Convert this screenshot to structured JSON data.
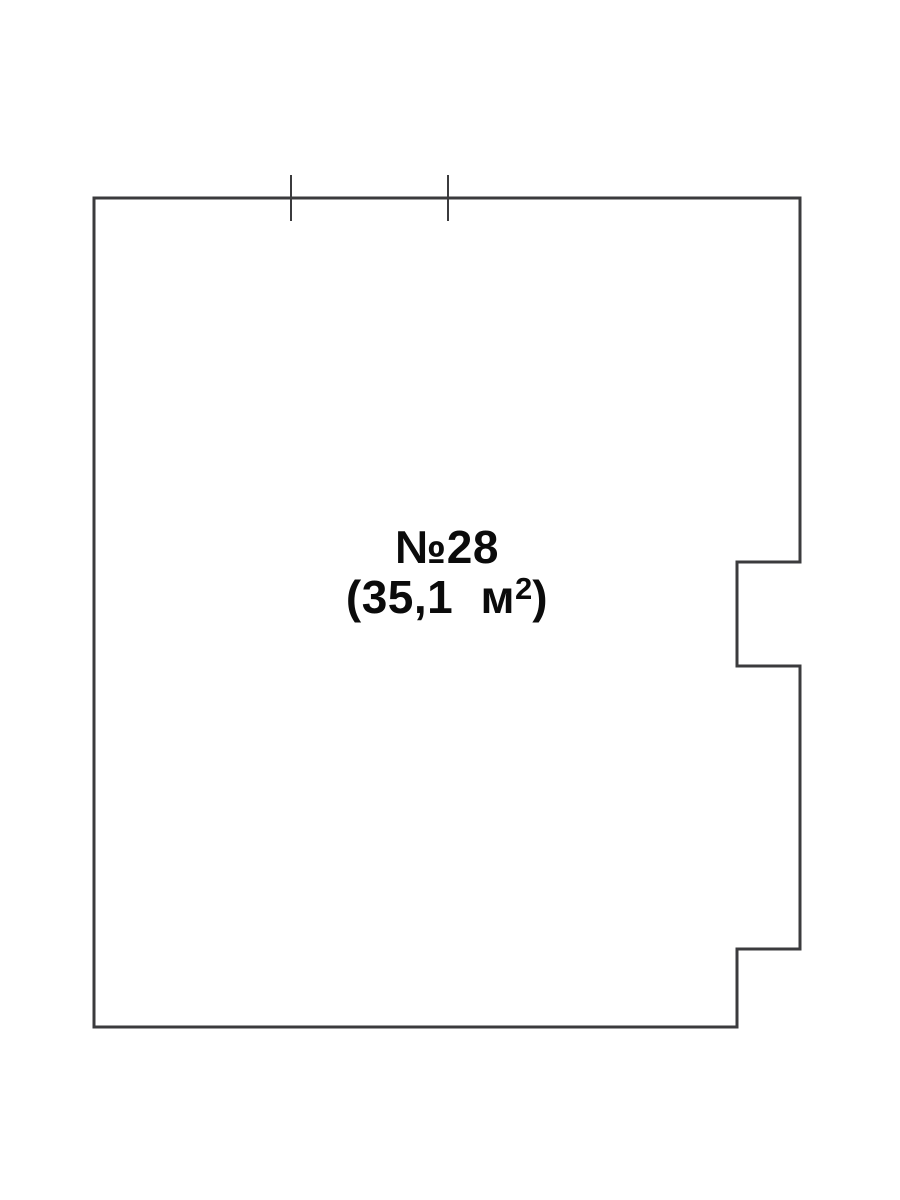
{
  "page": {
    "background_color": "#ffffff"
  },
  "floor_plan": {
    "stroke_color": "#3b3b3d",
    "text_color": "#0b0b0b",
    "wall_stroke_width": 3,
    "tick_stroke_width": 2,
    "unit": {
      "number_label": "№28",
      "area_prefix": "(35,1 м",
      "area_superscript": "2",
      "area_suffix": ")"
    },
    "outline_points": [
      [
        94,
        198
      ],
      [
        800,
        198
      ],
      [
        800,
        562
      ],
      [
        737,
        562
      ],
      [
        737,
        666
      ],
      [
        800,
        666
      ],
      [
        800,
        949
      ],
      [
        737,
        949
      ],
      [
        737,
        1027
      ],
      [
        94,
        1027
      ]
    ],
    "ticks": [
      {
        "x": 291,
        "y1": 175,
        "y2": 221
      },
      {
        "x": 448,
        "y1": 175,
        "y2": 221
      }
    ]
  }
}
